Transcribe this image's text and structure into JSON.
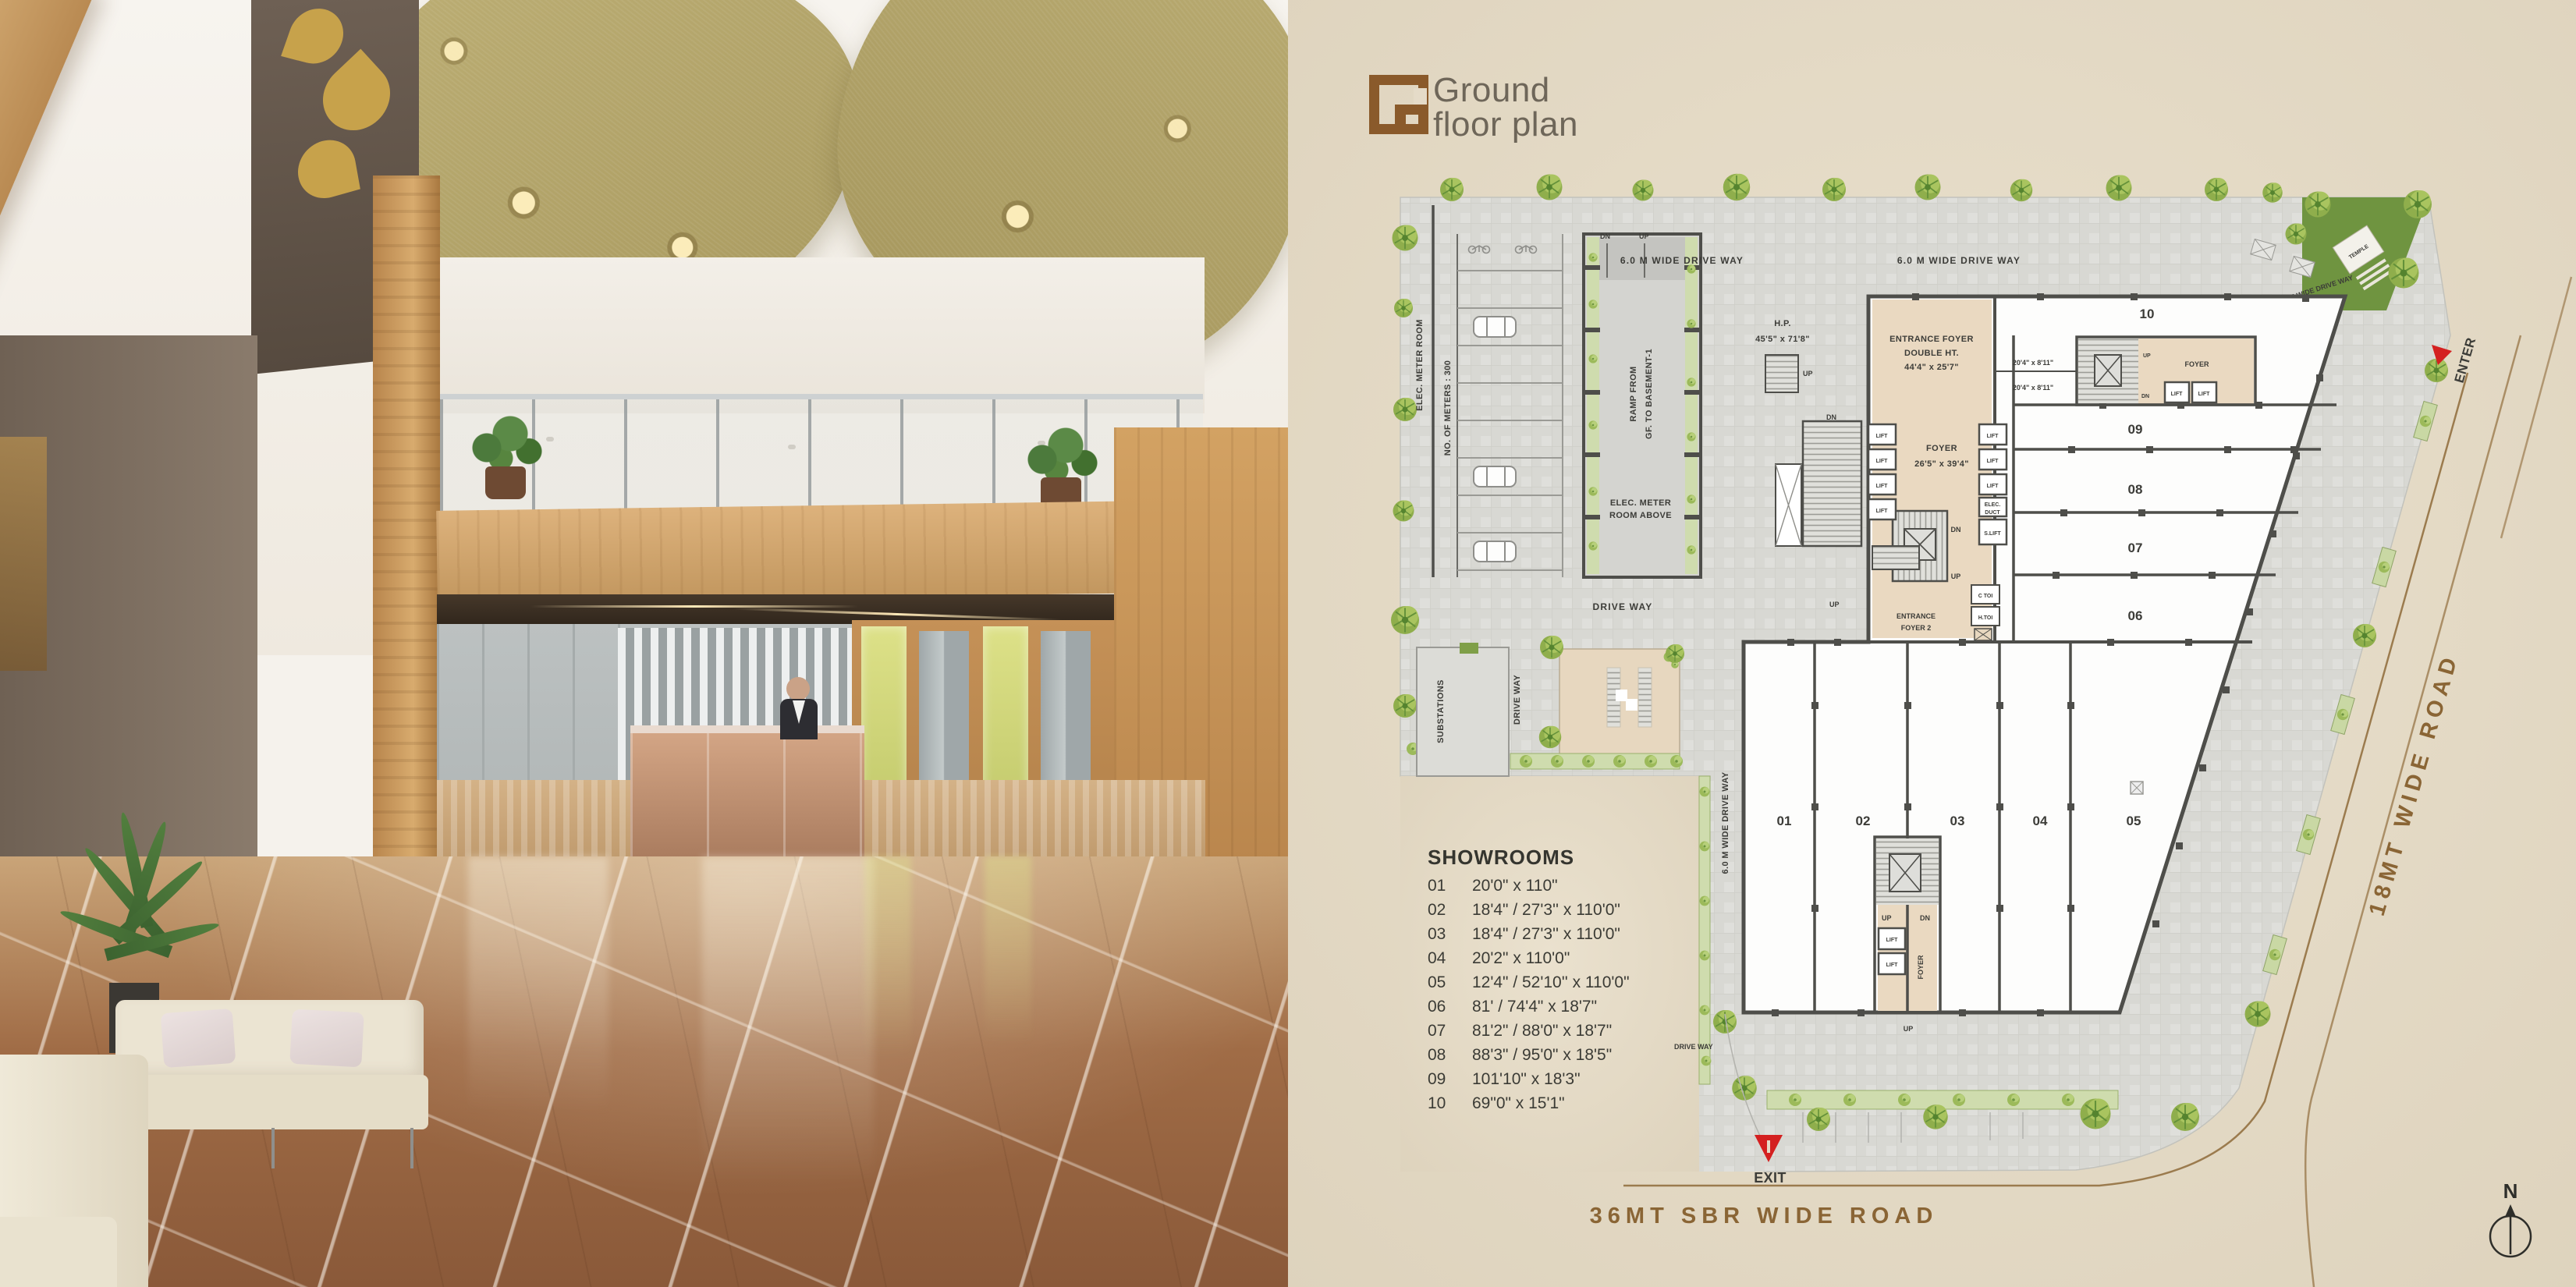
{
  "plan": {
    "logo_letter": "G",
    "title_line1": "Ground",
    "title_line2": "floor plan",
    "legend": {
      "title": "SHOWROOMS",
      "items": [
        {
          "no": "01",
          "dim": "20'0\" x 110\""
        },
        {
          "no": "02",
          "dim": "18'4\" / 27'3'' x 110'0\""
        },
        {
          "no": "03",
          "dim": "18'4\" / 27'3'' x 110'0\""
        },
        {
          "no": "04",
          "dim": "20'2\" x 110'0\""
        },
        {
          "no": "05",
          "dim": "12'4\" / 52'10'' x 110'0\""
        },
        {
          "no": "06",
          "dim": "81' / 74'4\" x 18'7\""
        },
        {
          "no": "07",
          "dim": "81'2\" / 88'0\" x 18'7\""
        },
        {
          "no": "08",
          "dim": "88'3\" / 95'0\" x 18'5\""
        },
        {
          "no": "09",
          "dim": "101'10\" x 18'3\""
        },
        {
          "no": "10",
          "dim": "69\"0\" x 15'1\""
        }
      ]
    },
    "roads": {
      "bottom": "36MT SBR WIDE ROAD",
      "right": "18MT WIDE ROAD"
    },
    "labels": {
      "dw6": "6.0 M WIDE DRIVE WAY",
      "drive_way": "DRIVE WAY",
      "substations": "SUBSTATIONS",
      "elec_meter_room": "ELEC. METER ROOM",
      "no_of_meters": "NO. OF METERS : 300",
      "ramp1": "RAMP FROM",
      "ramp2": "GF. TO BASEMENT-1",
      "meter_above1": "ELEC. METER",
      "meter_above2": "ROOM ABOVE",
      "hp": "H.P.",
      "hp_dim": "45'5\" x 71'8\"",
      "ef1": "ENTRANCE FOYER",
      "ef2": "DOUBLE HT.",
      "ef_dim": "44'4\" x 25'7\"",
      "foyer": "FOYER",
      "foyer_dim": "26'5\" x 39'4\"",
      "ef2_1": "ENTRANCE",
      "ef2_2": "FOYER 2",
      "lift": "LIFT",
      "s_lift": "S.LIFT",
      "elec_duct1": "ELEC.",
      "elec_duct2": "DUCT",
      "c_toi": "C TOI",
      "h_toi": "H.TOI",
      "up": "UP",
      "dn": "DN",
      "dim_10": "20'4\" x 8'11\"",
      "temple": "TEMPLE",
      "enter": "ENTER",
      "exit": "EXIT",
      "north": "N"
    },
    "nums": [
      "01",
      "02",
      "03",
      "04",
      "05",
      "06",
      "07",
      "08",
      "09",
      "10"
    ]
  },
  "colors": {
    "accent_brown": "#8a5a2b",
    "road_text": "#8a6535",
    "paper": "#e5dbc8",
    "paving": "#d8d8d3",
    "wall": "#4e4e4a",
    "foyer_fill": "#ead9c1",
    "landscape_green": "#8fae4c",
    "temple_green": "#6f9440",
    "arrow_red": "#d42020"
  }
}
